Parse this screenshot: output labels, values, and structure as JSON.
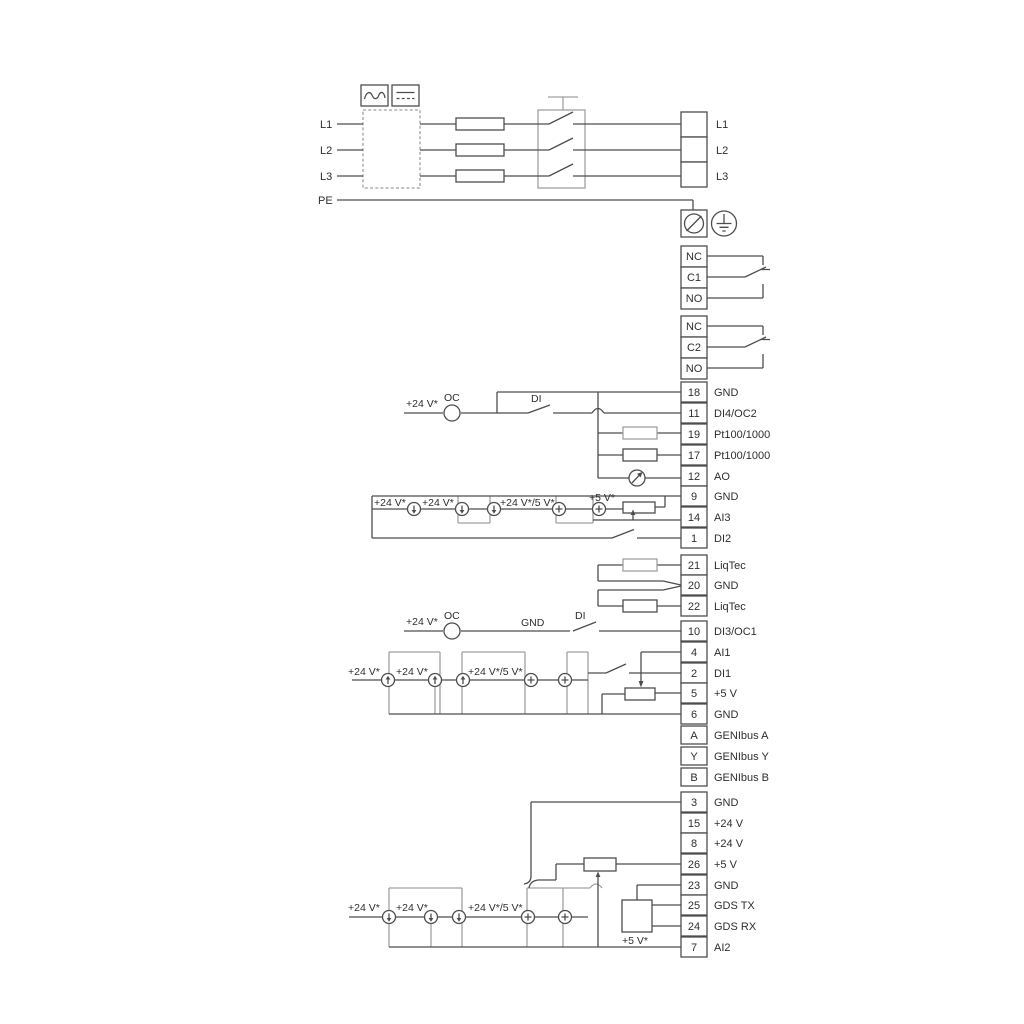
{
  "colors": {
    "line_dark": "#4d4d4d",
    "line_gray": "#a0a0a0",
    "text_color": "#2e2e2e",
    "background": "#ffffff"
  },
  "texts": {
    "plus24": "+24 V*",
    "plus24or5": "+24 V*/5 V*",
    "plus5": "+5 V*",
    "oc": "OC",
    "di": "DI",
    "gnd": "GND"
  },
  "power_input": {
    "l1": "L1",
    "l2": "L2",
    "l3": "L3",
    "pe": "PE"
  },
  "mains_terminals": {
    "l1": "L1",
    "l2": "L2",
    "l3": "L3"
  },
  "relay1": {
    "nc": "NC",
    "c": "C1",
    "no": "NO"
  },
  "relay2": {
    "nc": "NC",
    "c": "C2",
    "no": "NO"
  },
  "strip_a": [
    {
      "num": "18",
      "label": "GND"
    },
    {
      "num": "11",
      "label": "DI4/OC2"
    },
    {
      "num": "19",
      "label": "Pt100/1000"
    },
    {
      "num": "17",
      "label": "Pt100/1000"
    },
    {
      "num": "12",
      "label": "AO"
    },
    {
      "num": "9",
      "label": "GND"
    },
    {
      "num": "14",
      "label": "AI3"
    },
    {
      "num": "1",
      "label": "DI2"
    }
  ],
  "strip_b": [
    {
      "num": "21",
      "label": "LiqTec"
    },
    {
      "num": "20",
      "label": "GND"
    },
    {
      "num": "22",
      "label": "LiqTec"
    }
  ],
  "strip_c": [
    {
      "num": "10",
      "label": "DI3/OC1"
    },
    {
      "num": "4",
      "label": "AI1"
    },
    {
      "num": "2",
      "label": "DI1"
    },
    {
      "num": "5",
      "label": "+5 V"
    },
    {
      "num": "6",
      "label": "GND"
    }
  ],
  "strip_genibus": [
    {
      "num": "A",
      "label": "GENIbus A"
    },
    {
      "num": "Y",
      "label": "GENIbus Y"
    },
    {
      "num": "B",
      "label": "GENIbus B"
    }
  ],
  "strip_d": [
    {
      "num": "3",
      "label": "GND"
    },
    {
      "num": "15",
      "label": "+24 V"
    },
    {
      "num": "8",
      "label": "+24 V"
    },
    {
      "num": "26",
      "label": "+5 V"
    },
    {
      "num": "23",
      "label": "GND"
    },
    {
      "num": "25",
      "label": "GDS TX"
    },
    {
      "num": "24",
      "label": "GDS RX"
    },
    {
      "num": "7",
      "label": "AI2"
    }
  ]
}
